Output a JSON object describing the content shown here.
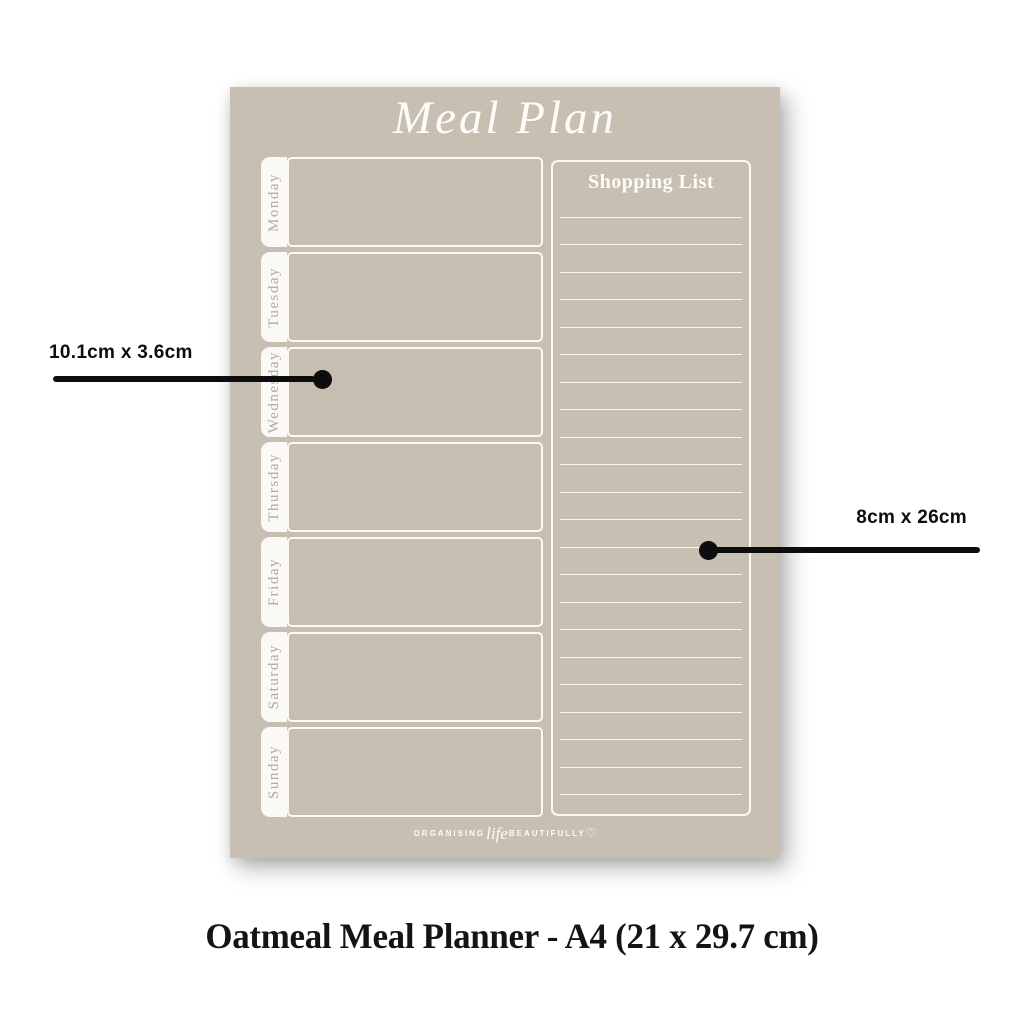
{
  "planner": {
    "title": "Meal Plan",
    "days": [
      "Monday",
      "Tuesday",
      "Wednesday",
      "Thursday",
      "Friday",
      "Saturday",
      "Sunday"
    ],
    "shopping_list": {
      "title": "Shopping List",
      "line_count": 22
    },
    "branding": {
      "word1": "ORGANISING",
      "script_word": "life",
      "word2": "BEAUTIFULLY",
      "heart": "♡"
    }
  },
  "annotations": {
    "day_box_size": "10.1cm x 3.6cm",
    "shopping_list_size": "8cm x 26cm"
  },
  "caption": "Oatmeal Meal Planner - A4 (21 x 29.7 cm)",
  "colors": {
    "canvas_bg": "#ffffff",
    "page_bg": "#c7bfb2",
    "box_fill": "#c6beb1",
    "tab_bg": "#fbf9f5",
    "line_white": "#fbf9f4",
    "day_text": "#b3a99a",
    "title_white": "#fdfcf8",
    "annotation_black": "#0d0d0d",
    "caption_black": "#141414"
  }
}
